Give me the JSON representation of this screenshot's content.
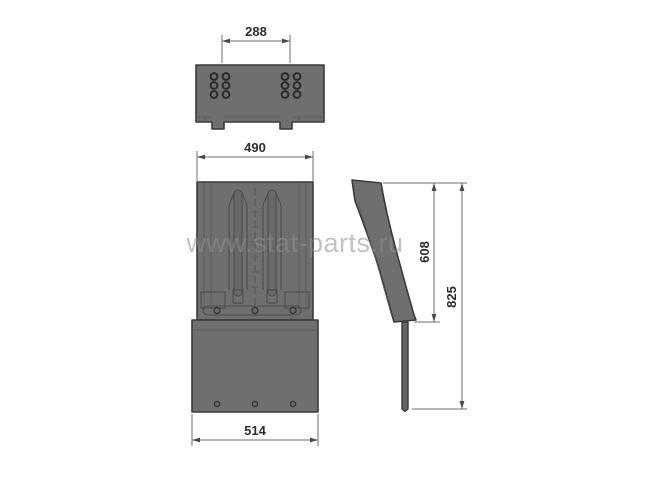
{
  "meta": {
    "title": "Technical drawing of mudflap bracket part, three orthographic views",
    "background": "#ffffff"
  },
  "watermark": {
    "text": "www.stat-parts.ru",
    "color": "#8f8f8f"
  },
  "colors": {
    "part_fill": "#6f6f6f",
    "part_fill_dark": "#646464",
    "part_outline": "#3a3a3a",
    "detail_line": "#4e4e4e",
    "dimension_line": "#6e6e6e",
    "dimension_text": "#2d2d2d",
    "watermark_text": "#8f8f8f"
  },
  "views": {
    "top": {
      "name": "top view",
      "bolt_hole_count": 12,
      "tabs": 2
    },
    "front": {
      "name": "front view",
      "slots": 2,
      "bottom_hole_count": 3
    },
    "side": {
      "name": "side profile view"
    }
  },
  "dimensions": [
    {
      "id": "dim-288",
      "value": "288",
      "orientation": "horizontal",
      "view": "top"
    },
    {
      "id": "dim-490",
      "value": "490",
      "orientation": "horizontal",
      "view": "front"
    },
    {
      "id": "dim-608",
      "value": "608",
      "orientation": "vertical",
      "view": "side"
    },
    {
      "id": "dim-825",
      "value": "825",
      "orientation": "vertical",
      "view": "side"
    },
    {
      "id": "dim-514",
      "value": "514",
      "orientation": "horizontal",
      "view": "front"
    }
  ]
}
